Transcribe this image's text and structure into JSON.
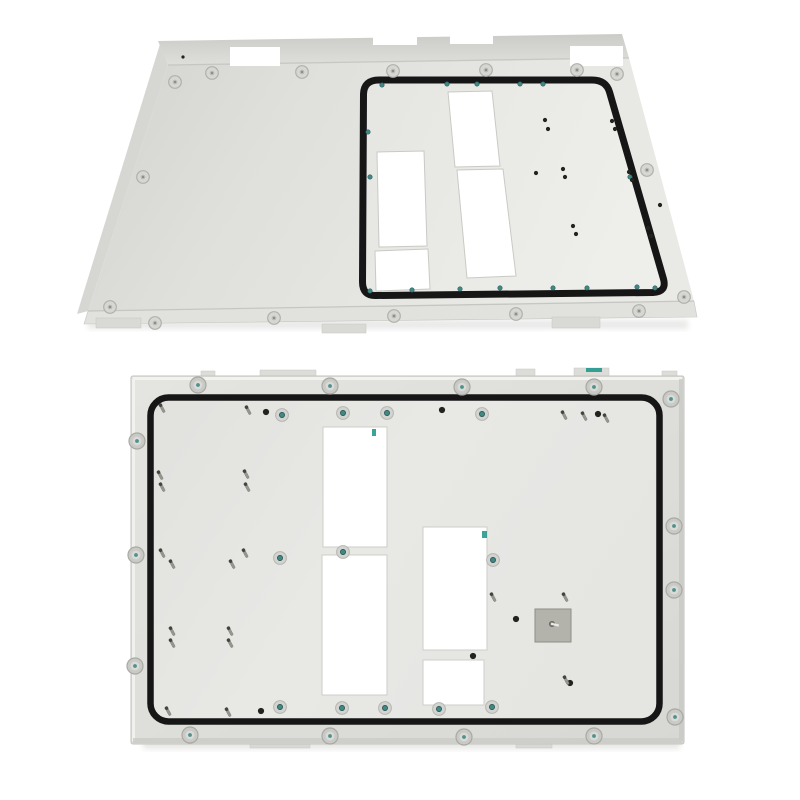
{
  "meta": {
    "subject": "photograph of two white powder-coated sheet-metal enclosure panels",
    "top_view": "rear mounting panel in perspective with black sealing gasket",
    "bottom_view": "front-facing mounting panel with perimeter gasket"
  },
  "colors": {
    "background": "#ffffff",
    "gasket": "#161616",
    "panel_face_light": "#e9e9e5",
    "panel_face_mid": "#dededa",
    "panel_face_dark": "#cfcfcb",
    "flange_dark": "#c9c9c5",
    "edge_highlight": "#f4f4f0",
    "edge_shade": "#c6c6c2",
    "screw_head": "#c9c9c5",
    "screw_rim": "#a8a8a4",
    "screw_inner": "#dadad6",
    "screw_center_teal": "#3f8985",
    "screw_center_gray": "#82827e",
    "stud_body": "#96968f",
    "stud_tip": "#44443e",
    "hole_dark": "#23231e",
    "teal_hole": "#3f8987",
    "plate_fill": "#b3b3ab",
    "plate_edge": "#8f8f87",
    "artifact_teal": "#18948a",
    "shadow": "#d4d4d0"
  },
  "top_panel": {
    "flange": [
      [
        158,
        41
      ],
      [
        622,
        34
      ],
      [
        629,
        58
      ],
      [
        168,
        65
      ]
    ],
    "face": [
      [
        168,
        65
      ],
      [
        629,
        58
      ],
      [
        694,
        301
      ],
      [
        88,
        311
      ]
    ],
    "lip": [
      [
        88,
        311
      ],
      [
        694,
        301
      ],
      [
        697,
        317
      ],
      [
        84,
        324
      ]
    ],
    "left_fold": [
      [
        160,
        44
      ],
      [
        168,
        65
      ],
      [
        88,
        311
      ],
      [
        77,
        314
      ]
    ],
    "feet": [
      [
        96,
        318,
        45,
        10
      ],
      [
        322,
        324,
        44,
        9
      ],
      [
        552,
        317,
        48,
        11
      ]
    ],
    "flange_holes": [
      [
        230,
        47,
        50,
        19
      ],
      [
        570,
        46,
        53,
        20
      ]
    ],
    "flange_notches": [
      [
        373,
        33,
        44,
        12
      ],
      [
        450,
        32,
        43,
        12
      ]
    ],
    "flange_dot": [
      183,
      57
    ],
    "fold_lines": [
      [
        [
          168,
          65
        ],
        [
          629,
          58
        ]
      ],
      [
        [
          88,
          311
        ],
        [
          694,
          301
        ]
      ]
    ],
    "gasket_path": "M 379 80 L 592 80 Q 606 80 609.5 92 L 663.5 279 Q 667 292 653 292.5 L 376 295.5 Q 362.5 296 362.5 282 L 363.5 94 Q 364 80 379 80 Z",
    "cutouts": [
      [
        [
          377,
          152
        ],
        [
          424,
          151
        ],
        [
          427,
          246
        ],
        [
          379,
          247
        ]
      ],
      [
        [
          375,
          251
        ],
        [
          428,
          249
        ],
        [
          430,
          289
        ],
        [
          376,
          291
        ]
      ],
      [
        [
          448,
          92
        ],
        [
          492,
          91
        ],
        [
          500,
          166
        ],
        [
          455,
          167
        ]
      ],
      [
        [
          457,
          170
        ],
        [
          503,
          169
        ],
        [
          516,
          276
        ],
        [
          467,
          278
        ]
      ]
    ],
    "teal_holes": [
      [
        382,
        85
      ],
      [
        447,
        84
      ],
      [
        477,
        84
      ],
      [
        520,
        84
      ],
      [
        543,
        84
      ],
      [
        368,
        132
      ],
      [
        370,
        177
      ],
      [
        630,
        177
      ],
      [
        370,
        291
      ],
      [
        412,
        290
      ],
      [
        460,
        289
      ],
      [
        500,
        288
      ],
      [
        553,
        288
      ],
      [
        587,
        288
      ],
      [
        637,
        287
      ],
      [
        655,
        288
      ]
    ],
    "dark_holes": [
      [
        545,
        120
      ],
      [
        548,
        129
      ],
      [
        612,
        121
      ],
      [
        615,
        129
      ],
      [
        536,
        173
      ],
      [
        563,
        169
      ],
      [
        565,
        177
      ],
      [
        629,
        172
      ],
      [
        632,
        180
      ],
      [
        573,
        226
      ],
      [
        576,
        234
      ],
      [
        648,
        228
      ],
      [
        651,
        236
      ],
      [
        660,
        205
      ]
    ],
    "screws": [
      [
        212,
        73
      ],
      [
        302,
        72
      ],
      [
        393,
        71
      ],
      [
        486,
        70
      ],
      [
        577,
        70
      ],
      [
        617,
        74
      ],
      [
        175,
        82
      ],
      [
        143,
        177
      ],
      [
        110,
        307
      ],
      [
        155,
        323
      ],
      [
        274,
        318
      ],
      [
        394,
        316
      ],
      [
        516,
        314
      ],
      [
        639,
        311
      ],
      [
        647,
        170
      ],
      [
        684,
        297
      ]
    ]
  },
  "bottom_panel": {
    "outer": [
      131,
      376,
      553,
      368
    ],
    "tabs": [
      [
        201,
        371,
        14,
        6
      ],
      [
        260,
        370,
        56,
        7
      ],
      [
        516,
        369,
        19,
        8
      ],
      [
        574,
        368,
        35,
        9
      ],
      [
        662,
        371,
        15,
        6
      ]
    ],
    "feet": [
      [
        250,
        742,
        60,
        6
      ],
      [
        516,
        742,
        36,
        6
      ]
    ],
    "gasket": [
      150.5,
      397.5,
      509,
      324,
      18
    ],
    "cutouts": [
      [
        323,
        427,
        64,
        120
      ],
      [
        322,
        555,
        65,
        140
      ],
      [
        423,
        527,
        64,
        123
      ],
      [
        423,
        660,
        61,
        45
      ]
    ],
    "plate": [
      535,
      609,
      36,
      33
    ],
    "plate_pin": [
      552,
      624
    ],
    "outer_screws": [
      [
        198,
        385
      ],
      [
        330,
        386
      ],
      [
        462,
        387
      ],
      [
        594,
        387
      ],
      [
        671,
        399
      ],
      [
        674,
        526
      ],
      [
        674,
        590
      ],
      [
        675,
        717
      ],
      [
        594,
        736
      ],
      [
        464,
        737
      ],
      [
        330,
        736
      ],
      [
        190,
        735
      ],
      [
        137,
        441
      ],
      [
        136,
        555
      ],
      [
        135,
        666
      ]
    ],
    "inner_screws": [
      [
        282,
        415
      ],
      [
        343,
        413
      ],
      [
        387,
        413
      ],
      [
        482,
        414
      ],
      [
        280,
        558
      ],
      [
        343,
        552
      ],
      [
        493,
        560
      ],
      [
        280,
        707
      ],
      [
        342,
        708
      ],
      [
        385,
        708
      ],
      [
        439,
        709
      ],
      [
        492,
        707
      ]
    ],
    "dark_holes": [
      [
        266,
        412
      ],
      [
        442,
        410
      ],
      [
        598,
        414
      ],
      [
        261,
        711
      ],
      [
        473,
        656
      ],
      [
        516,
        619
      ],
      [
        570,
        683
      ]
    ],
    "studs": [
      [
        162,
        408
      ],
      [
        248,
        410
      ],
      [
        564,
        415
      ],
      [
        584,
        416
      ],
      [
        606,
        418
      ],
      [
        160,
        475
      ],
      [
        162,
        487
      ],
      [
        246,
        474
      ],
      [
        247,
        487
      ],
      [
        162,
        553
      ],
      [
        172,
        564
      ],
      [
        245,
        553
      ],
      [
        232,
        564
      ],
      [
        172,
        631
      ],
      [
        172,
        643
      ],
      [
        230,
        631
      ],
      [
        230,
        643
      ],
      [
        168,
        711
      ],
      [
        228,
        712
      ],
      [
        493,
        597
      ],
      [
        565,
        597
      ],
      [
        566,
        680
      ]
    ],
    "artifacts": [
      [
        372,
        429,
        4,
        7
      ],
      [
        482,
        531,
        5,
        7
      ],
      [
        586,
        368,
        16,
        4
      ]
    ]
  }
}
